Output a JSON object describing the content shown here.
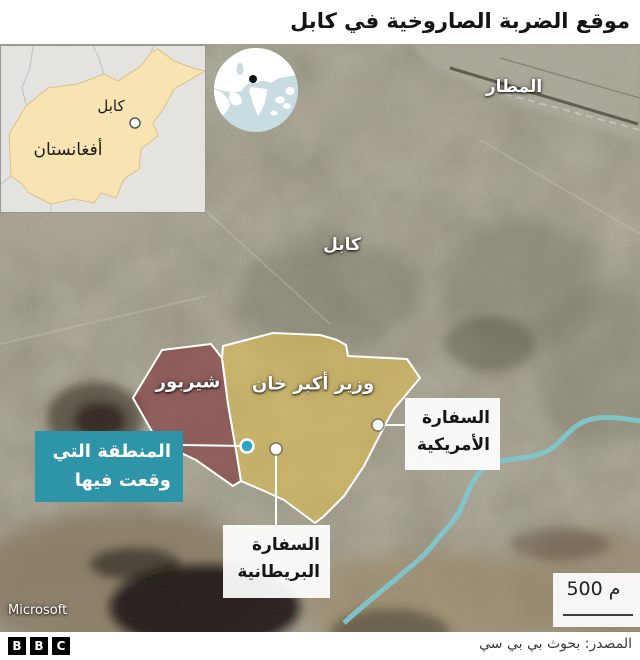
{
  "header": {
    "title": "موقع الضربة الصاروخية في كابل"
  },
  "inset_map": {
    "country_label": "أفغانستان",
    "city_label": "كابل"
  },
  "map": {
    "labels": {
      "airport": "المطار",
      "city": "كابل"
    },
    "districts": {
      "sherpur": "شيربور",
      "wazir_akbar_khan": "وزير أكبر خان"
    },
    "callouts": {
      "strike_area": {
        "line1": "المنطقة التي",
        "line2": "وقعت فيها",
        "full": "المنطقة التي وقعت فيها"
      },
      "us_embassy": {
        "line1": "السفارة",
        "line2": "الأمريكية",
        "full": "السفارة الأمريكية"
      },
      "uk_embassy": {
        "line1": "السفارة",
        "line2": "البريطانية",
        "full": "السفارة البريطانية"
      }
    },
    "scale_label": "500 م",
    "attribution": "Microsoft"
  },
  "footer": {
    "logo_letters": [
      "B",
      "B",
      "C"
    ],
    "source": "المصدر: بحوث بي بي سي"
  },
  "colors": {
    "accent_teal_box": "#2E94A8",
    "strike_dot": "#2AA6C9",
    "overlay_red": "#7D2832",
    "overlay_yellow": "#DABC54",
    "river": "#7FC6CE",
    "inset_country_fill": "#F8E3B2",
    "globe_sea": "#C7DDE2",
    "title_text": "#141414"
  }
}
